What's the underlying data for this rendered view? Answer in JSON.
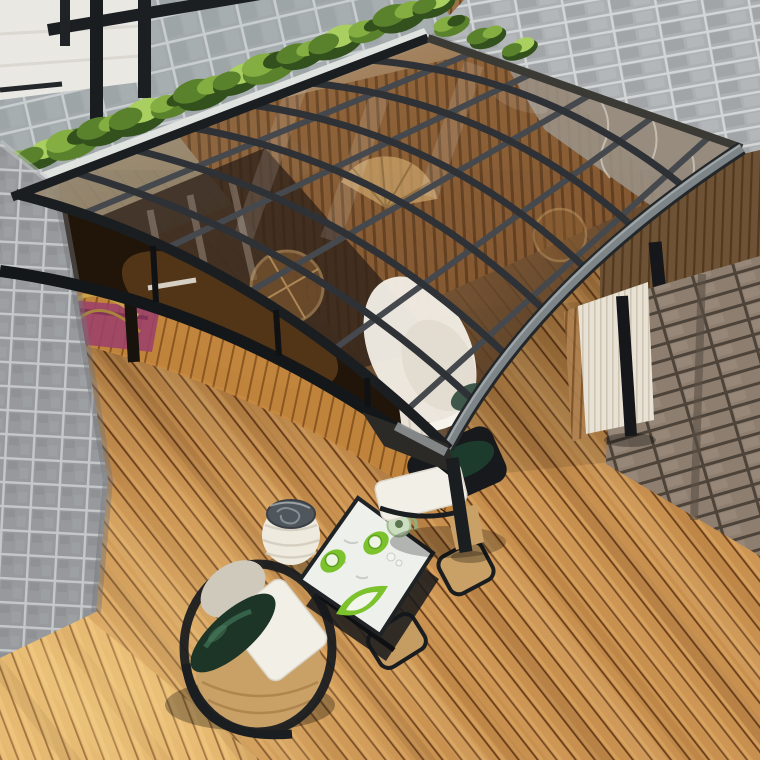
{
  "scene": {
    "description": "Bird's-eye photo of a black aluminum frame curved glass canopy over a wooden deck patio with tea table, barrel chairs, woven stool, stone and brick pillars, ivy-edged paver walkway and pleated screen",
    "objects": [
      "glass-canopy",
      "aluminum-frame",
      "wood-deck",
      "paver-walkway",
      "ivy-hedge",
      "wood-slat-fence",
      "gray-brick-wall",
      "brown-brick-pillar",
      "stone-pillar",
      "interior-room",
      "magenta-rug",
      "gold-table",
      "white-curtain",
      "pleated-screen",
      "tea-table",
      "teapot",
      "green-saucers",
      "leaf-dish",
      "barrel-chair",
      "canopy-post",
      "woven-stool",
      "lounge-chair"
    ]
  },
  "palette": {
    "deck_base": "#c8904f",
    "deck_base2": "#dcab63",
    "deck_gap": "#6b3e1b",
    "deck_light": "#e7b56e",
    "paver_base": "#a3a9ac",
    "paver_joint": "#c8cdcf",
    "brick_gray": "#adb0b2",
    "brick_gray_dark": "#969a9d",
    "brick_mortar": "#d3d6d7",
    "brick_brown": "#8d7e70",
    "brick_brown_mortar": "#4d4339",
    "stone_base": "#97999c",
    "stone_mortar": "#c5c8c9",
    "stone_dark": "#83868a",
    "ivy_dark": "#33511d",
    "ivy_mid": "#5a822c",
    "ivy_light": "#84ae41",
    "ivy_bright": "#a8cf60",
    "fence_slat": "#b08252",
    "fence_gap": "#7c5328",
    "pebble": "#e3e6e1",
    "wall_white": "#eae8e3",
    "frame_dark": "#1b1e21",
    "grid_gray": "#45494d",
    "rafter_gray": "#2e3236",
    "eave_gray": "#7e8589",
    "eave_light": "#aab0b3",
    "glass_a": "#b7a995",
    "glass_b": "#97795a",
    "glass_c": "#6b4c30",
    "glass_d": "#452f1c",
    "interior_dark": "#211509",
    "floor_warm": "#c8893f",
    "rug": "#9c4168",
    "gold": "#c9a24a",
    "curtain": "#e8e2d6",
    "pleat": "#cfc5b1",
    "cushion_white": "#f2efe7",
    "pillow_green": "#1c3527",
    "pillow_sheen": "#39664c",
    "rattan": "#c9a066",
    "chair_beige": "#cfc9bc",
    "marble": "#eef0ec",
    "item_green": "#7cc22c",
    "teapot": "#cbdfc0",
    "stool_white": "#efeade",
    "stool_top": "#4f565c",
    "stool_swirl": "#8b949b"
  }
}
